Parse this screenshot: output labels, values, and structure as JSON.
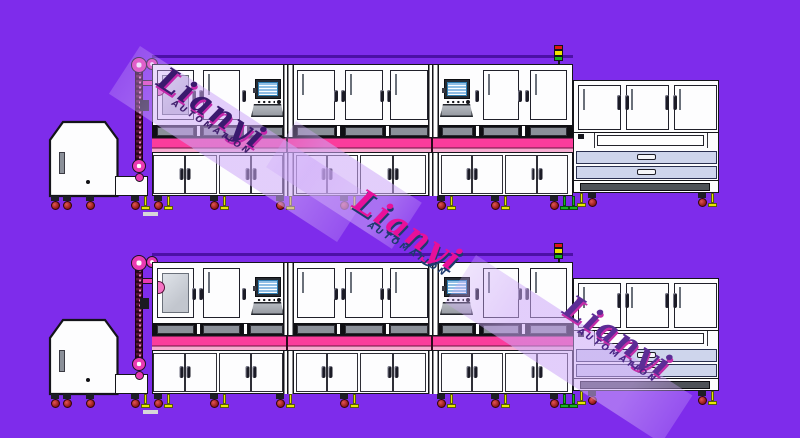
{
  "canvas": {
    "width": 800,
    "height": 438,
    "description": "CAD side-view drawing of two identical automated production lines on purple background"
  },
  "palette": {
    "bg": "#7e2ceb",
    "rail": "#4c10a6",
    "ink": "#14141a",
    "white": "#fdfdfe",
    "glassLight": "#dfe3e9",
    "glassDark": "#c2c6ce",
    "glassBorder": "#6a707a",
    "ventDark": "#0f0f13",
    "ventInsert": "#8b9099",
    "pink": "#fb3c9c",
    "pinkLight": "#f7abd0",
    "pinkDivider": "#6e1240",
    "magenta": "#e93ab2",
    "chainDot": "#e87ec0",
    "screen": "#c2e6f8",
    "screenBorder": "#2f7fb4",
    "drawer": "#ced5ec",
    "signalRed": "#e01616",
    "signalYellow": "#f0e400",
    "signalGreen": "#16b022",
    "footYellow": "#e6e800",
    "footGreen": "#1ab424",
    "dash": "#d6d6d8",
    "bandTint": "rgba(205,168,248,0.5)"
  },
  "rows": [
    {
      "name": "production-line-row-1",
      "top": 45
    },
    {
      "name": "production-line-row-2",
      "top": 243
    }
  ],
  "equipment": {
    "row_count": 2,
    "components": [
      "hopper-feeder",
      "elevator-chain-conveyor",
      "process-enclosure-3-bays",
      "hmi-monitor",
      "pink-conveyor-band",
      "double-door-cabinets",
      "signal-tower",
      "end-cabinet-with-drawers"
    ]
  },
  "watermarks": [
    {
      "brand": "Lianyi",
      "sub": "AUTOMATION",
      "angle": 33,
      "band": {
        "x": 140,
        "y": 46,
        "len": 272,
        "w": 57
      },
      "text": {
        "x": 170,
        "y": 62
      },
      "colors": {
        "main": "#3a1a6e",
        "shadow": "#c428aa",
        "sub": "#42206e"
      }
    },
    {
      "brand": "Lianyi",
      "sub": "AUTOMATION",
      "angle": 33,
      "band": {
        "x": 296,
        "y": 121,
        "len": 150,
        "w": 55
      },
      "text": {
        "x": 366,
        "y": 184
      },
      "colors": {
        "main": "#e8109a",
        "shadow": "#1d3a6e",
        "sub": "#1d3a6e"
      }
    },
    {
      "brand": "Lianyi",
      "sub": "AUTOMATION",
      "angle": 33,
      "band": {
        "x": 476,
        "y": 255,
        "len": 258,
        "w": 57
      },
      "text": {
        "x": 576,
        "y": 290
      },
      "colors": {
        "main": "#5c2d96",
        "shadow": "#c42ca8",
        "sub": "#4a2486"
      }
    }
  ]
}
